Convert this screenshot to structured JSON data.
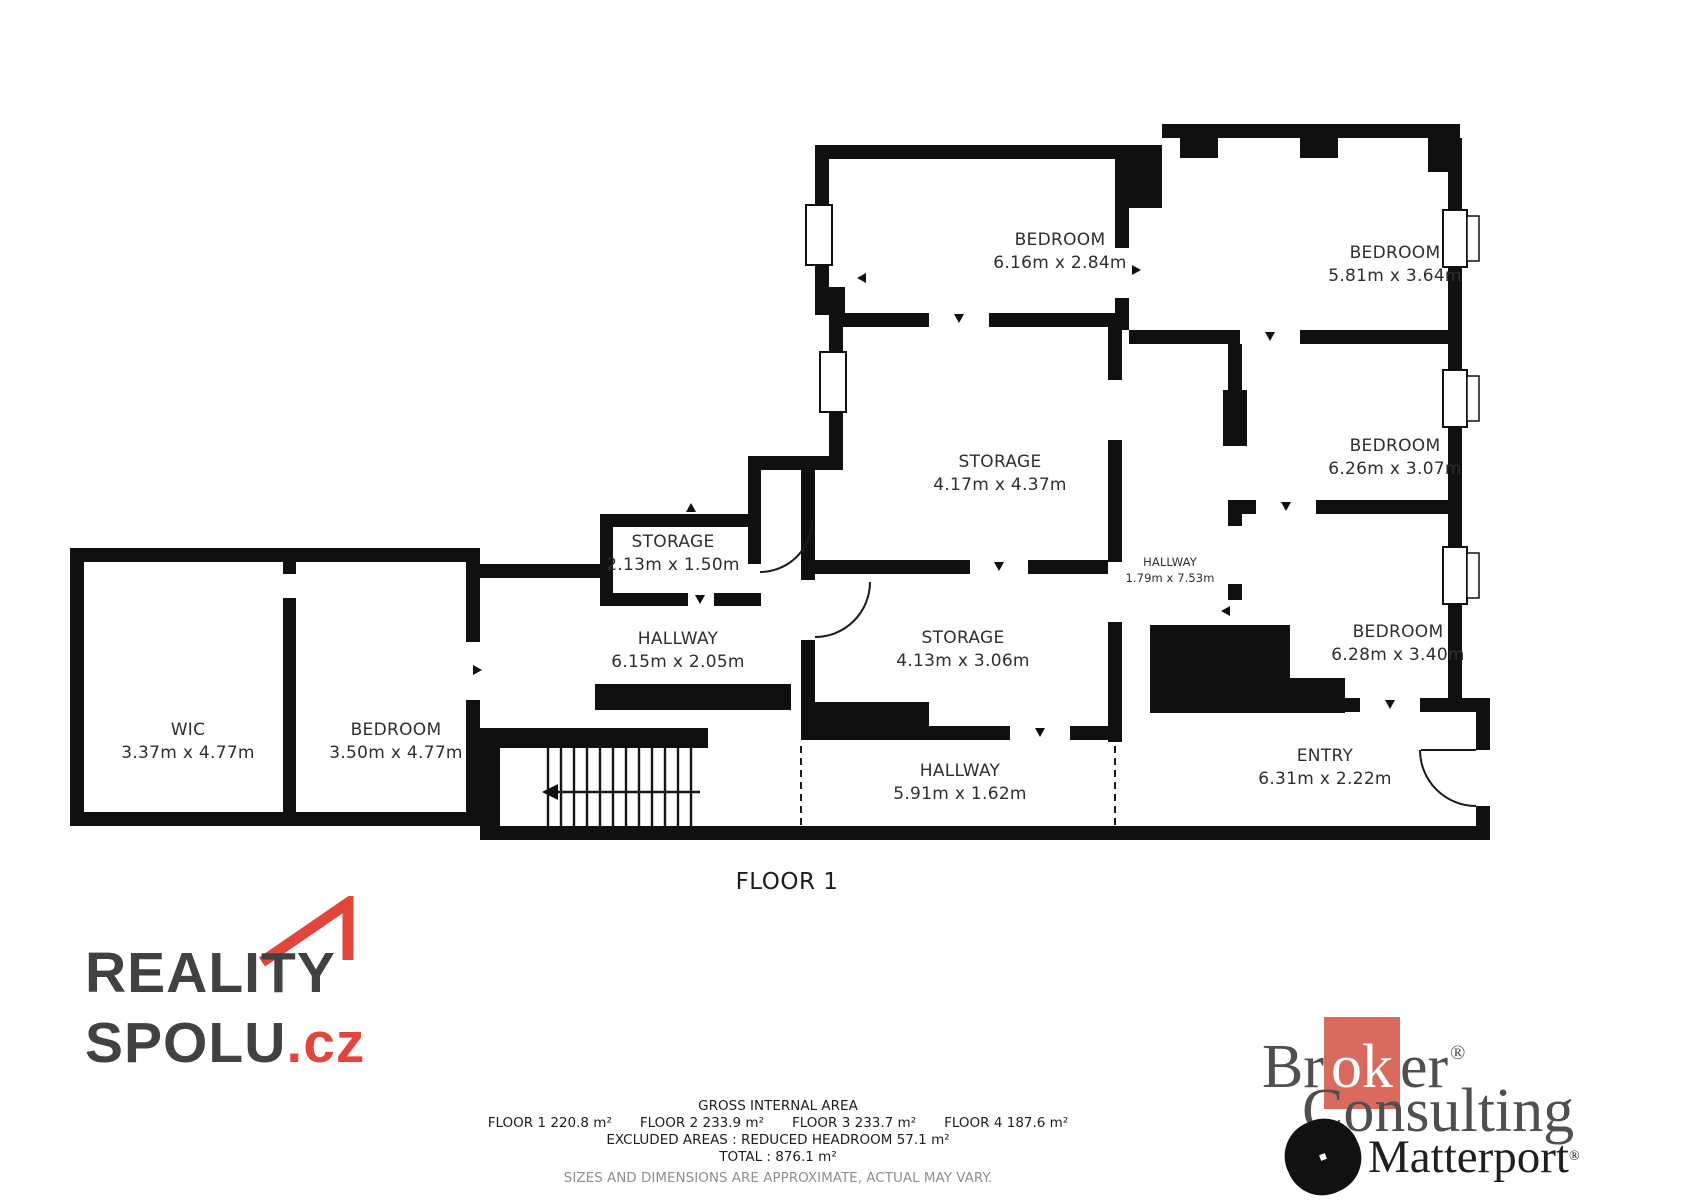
{
  "colors": {
    "wall_black": "#101010",
    "accent_red": "#e2453c",
    "broker_red": "#d96a5e",
    "text_dark": "#414141",
    "footer_gray": "#8f8f8f"
  },
  "plan": {
    "floor_label": "FLOOR 1",
    "rooms": [
      {
        "name": "BEDROOM",
        "dims": "6.16m x 2.84m",
        "x": 1060,
        "y": 252,
        "small": false
      },
      {
        "name": "BEDROOM",
        "dims": "5.81m x 3.64m",
        "x": 1395,
        "y": 265,
        "small": false
      },
      {
        "name": "STORAGE",
        "dims": "4.17m x 4.37m",
        "x": 1000,
        "y": 474,
        "small": false
      },
      {
        "name": "BEDROOM",
        "dims": "6.26m x 3.07m",
        "x": 1395,
        "y": 458,
        "small": false
      },
      {
        "name": "HALLWAY",
        "dims": "1.79m x 7.53m",
        "x": 1170,
        "y": 570,
        "small": true
      },
      {
        "name": "STORAGE",
        "dims": "2.13m x 1.50m",
        "x": 673,
        "y": 554,
        "small": false
      },
      {
        "name": "HALLWAY",
        "dims": "6.15m x 2.05m",
        "x": 678,
        "y": 651,
        "small": false
      },
      {
        "name": "BEDROOM",
        "dims": "6.28m x 3.40m",
        "x": 1398,
        "y": 644,
        "small": false
      },
      {
        "name": "WIC",
        "dims": "3.37m x 4.77m",
        "x": 188,
        "y": 742,
        "small": false
      },
      {
        "name": "BEDROOM",
        "dims": "3.50m x 4.77m",
        "x": 396,
        "y": 742,
        "small": false
      },
      {
        "name": "STORAGE",
        "dims": "4.13m x 3.06m",
        "x": 963,
        "y": 650,
        "small": false
      },
      {
        "name": "HALLWAY",
        "dims": "5.91m x 1.62m",
        "x": 960,
        "y": 783,
        "small": false
      },
      {
        "name": "ENTRY",
        "dims": "6.31m x 2.22m",
        "x": 1325,
        "y": 768,
        "small": false
      }
    ]
  },
  "footer": {
    "title": "GROSS INTERNAL AREA",
    "floor_areas": [
      "FLOOR 1 220.8 m²",
      "FLOOR 2 233.9 m²",
      "FLOOR 3 233.7 m²",
      "FLOOR 4 187.6 m²"
    ],
    "excluded": "EXCLUDED AREAS :  REDUCED HEADROOM 57.1 m²",
    "total": "TOTAL :  876.1 m²",
    "disclaimer": "SIZES AND DIMENSIONS ARE APPROXIMATE, ACTUAL MAY VARY."
  },
  "logos": {
    "reality": {
      "line1": "REALITY",
      "line2": "SPOLU",
      "suffix": ".cz"
    },
    "broker": {
      "part1": "Br",
      "ok": "ok",
      "part2": "er",
      "reg": "®",
      "consulting": "Consulting"
    },
    "matterport": {
      "name": "Matterport",
      "reg": "®"
    }
  }
}
